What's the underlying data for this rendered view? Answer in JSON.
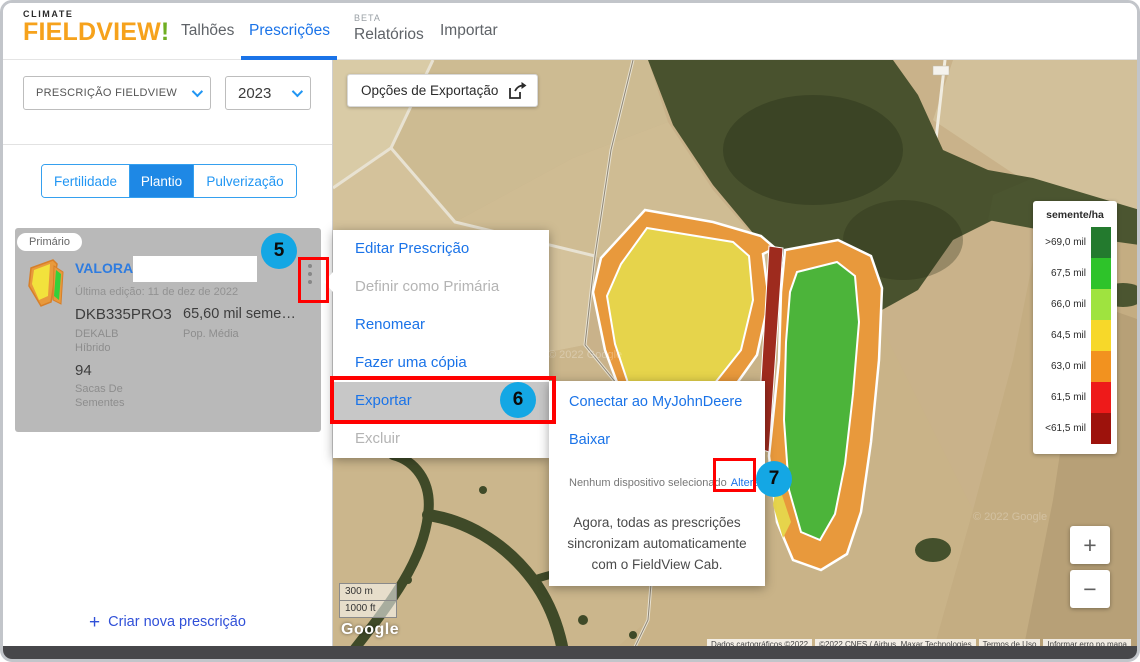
{
  "nav": {
    "logo": {
      "top": "CLIMATE",
      "main": "FIELDVIEW",
      "mark": "!"
    },
    "items": [
      {
        "label": "Talhões",
        "active": false
      },
      {
        "label": "Prescrições",
        "active": true
      },
      {
        "label": "Relatórios",
        "active": false,
        "beta": true
      },
      {
        "label": "Importar",
        "active": false
      }
    ],
    "beta": "BETA"
  },
  "sidebar": {
    "filter_type": "PRESCRIÇÃO FIELDVIEW",
    "filter_year": "2023",
    "tabs": [
      {
        "label": "Fertilidade",
        "active": false
      },
      {
        "label": "Plantio",
        "active": true
      },
      {
        "label": "Pulverização",
        "active": false
      }
    ],
    "card": {
      "badge": "Primário",
      "name": "VALORA_",
      "last_edit": "Última edição: 11 de dez de 2022",
      "hybrid": "DKB335PRO3",
      "hybrid_brand": "DEKALB",
      "hybrid_type": "Híbrido",
      "rate": "65,60 mil seme…",
      "rate_label": "Pop. Média",
      "bags": "94",
      "bags_label1": "Sacas De",
      "bags_label2": "Sementes"
    },
    "create": {
      "plus": "+",
      "label": "Criar nova prescrição"
    }
  },
  "map": {
    "export_label": "Opções de Exportação",
    "export_icon": "share-export-icon",
    "zoom_in": "+",
    "zoom_out": "−",
    "scale_m": "300 m",
    "scale_ft": "1000 ft",
    "google": "Google",
    "watermark": "© 2022 Google",
    "attribution": [
      "Dados cartográficos ©2022",
      "©2022 CNES / Airbus, Maxar Technologies",
      "Termos de Uso",
      "Informar erro no mapa"
    ]
  },
  "legend": {
    "title": "semente/ha",
    "entries": [
      {
        "label": ">69,0 mil",
        "color": "#237a2e"
      },
      {
        "label": "67,5 mil",
        "color": "#2ec32a"
      },
      {
        "label": "66,0 mil",
        "color": "#9fe33f"
      },
      {
        "label": "64,5 mil",
        "color": "#f7d829"
      },
      {
        "label": "63,0 mil",
        "color": "#f2921f"
      },
      {
        "label": "61,5 mil",
        "color": "#ee1a1a"
      },
      {
        "label": "<61,5 mil",
        "color": "#9d120c"
      }
    ]
  },
  "menu": {
    "items": [
      {
        "label": "Editar Prescrição",
        "enabled": true
      },
      {
        "label": "Definir como Primária",
        "enabled": false
      },
      {
        "label": "Renomear",
        "enabled": true
      },
      {
        "label": "Fazer uma cópia",
        "enabled": true
      },
      {
        "label": "Exportar",
        "enabled": true,
        "highlighted": true
      },
      {
        "label": "Excluir",
        "enabled": false
      }
    ]
  },
  "submenu": {
    "connect": "Conectar ao MyJohnDeere",
    "download": "Baixar",
    "device_status": "Nenhum dispositivo selecionado",
    "device_action": "Alterar",
    "note": "Agora, todas as prescrições sincronizam automaticamente com o FieldView Cab."
  },
  "annotations": {
    "c5": "5",
    "c6": "6",
    "c7": "7",
    "box_color": "#ff0000",
    "circle_color": "#14a7e4"
  },
  "colors": {
    "brand_orange": "#f6a21c",
    "accent_blue": "#1a73e8",
    "tab_active_blue": "#1e88e5",
    "zone_yellow": "#e6d44b",
    "zone_green": "#4cb43a",
    "zone_orange": "#e8993c",
    "zone_dark_red": "#9e2b1e"
  }
}
